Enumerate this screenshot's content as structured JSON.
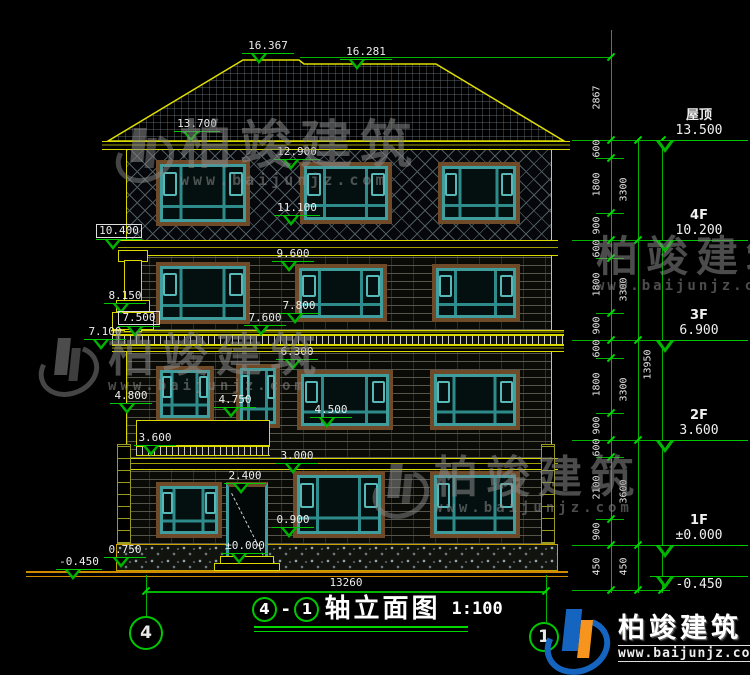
{
  "peaks": {
    "left": "16.367",
    "right": "16.281"
  },
  "labels": {
    "l13700": "13.700",
    "l12900": "12.900",
    "l11100": "11.100",
    "l10400": "10.400",
    "l9600": "9.600",
    "l8150": "8.150",
    "l7500": "7.500",
    "l7800": "7.800",
    "l7600": "7.600",
    "l7100": "7.100",
    "l6300": "6.300",
    "l4800": "4.800",
    "l4750": "4.750",
    "l4500": "4.500",
    "l3600": "3.600",
    "l3000": "3.000",
    "l2400": "2.400",
    "l0900": "0.900",
    "l0750": "0.750",
    "l0000": "±0.000",
    "lm450": "-0.450"
  },
  "right_markers": [
    {
      "floor": "屋顶",
      "value": "13.500"
    },
    {
      "floor": "4F",
      "value": "10.200"
    },
    {
      "floor": "3F",
      "value": "6.900"
    },
    {
      "floor": "2F",
      "value": "3.600"
    },
    {
      "floor": "1F",
      "value": "±0.000"
    },
    {
      "floor": "",
      "value": "-0.450"
    }
  ],
  "dims": {
    "inner": [
      "2867",
      "600",
      "1800",
      "900",
      "600",
      "1800",
      "900",
      "600",
      "1800",
      "900",
      "600",
      "2100",
      "900",
      "450"
    ],
    "mid": [
      "3300",
      "3300",
      "3300",
      "3600",
      "450"
    ],
    "total": "13950",
    "width": "13260"
  },
  "title": {
    "axis_a": "4",
    "axis_b": "1",
    "dash": "-",
    "name": "轴立面图",
    "scale": "1:100"
  },
  "brand": {
    "name": "柏竣建筑",
    "url": "www.baijunjz.com"
  }
}
